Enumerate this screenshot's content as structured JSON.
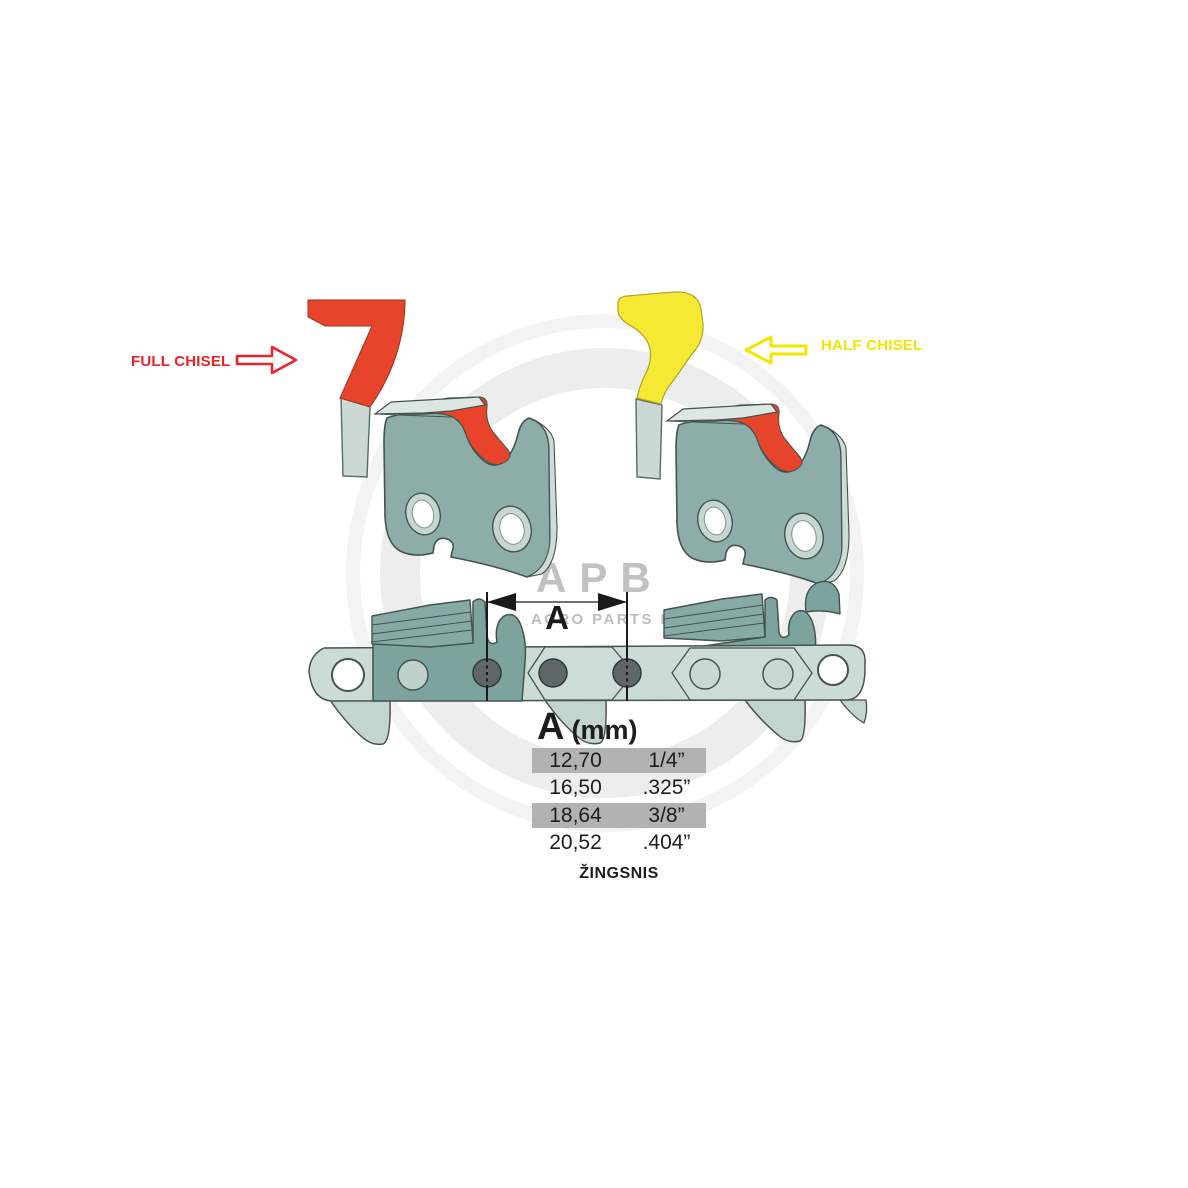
{
  "labels": {
    "full_chisel": "FULL CHISEL",
    "half_chisel": "HALF CHISEL"
  },
  "dimension": {
    "label": "A"
  },
  "watermark": {
    "logo": "APB",
    "tagline": "AGRO PARTS BALTIJA"
  },
  "table": {
    "header_symbol": "A",
    "header_unit": "(mm)",
    "rows": [
      {
        "mm": "12,70",
        "inches": "1/4”",
        "highlighted": true
      },
      {
        "mm": "16,50",
        "inches": ".325”",
        "highlighted": false
      },
      {
        "mm": "18,64",
        "inches": "3/8”",
        "highlighted": true
      },
      {
        "mm": "20,52",
        "inches": ".404”",
        "highlighted": false
      }
    ],
    "caption": "ŽINGSNIS"
  },
  "colors": {
    "full_chisel_red": "#e8432b",
    "half_chisel_yellow": "#f5e933",
    "label_red": "#ed2024",
    "label_yellow": "#f4e400",
    "link_body_teal": "#8cada8",
    "chain_strap_light": "#cbdbd5",
    "rivet_dark": "#5e6668",
    "table_row_gray": "#b2b2b2",
    "watermark_gray": "#c1c1c1"
  }
}
